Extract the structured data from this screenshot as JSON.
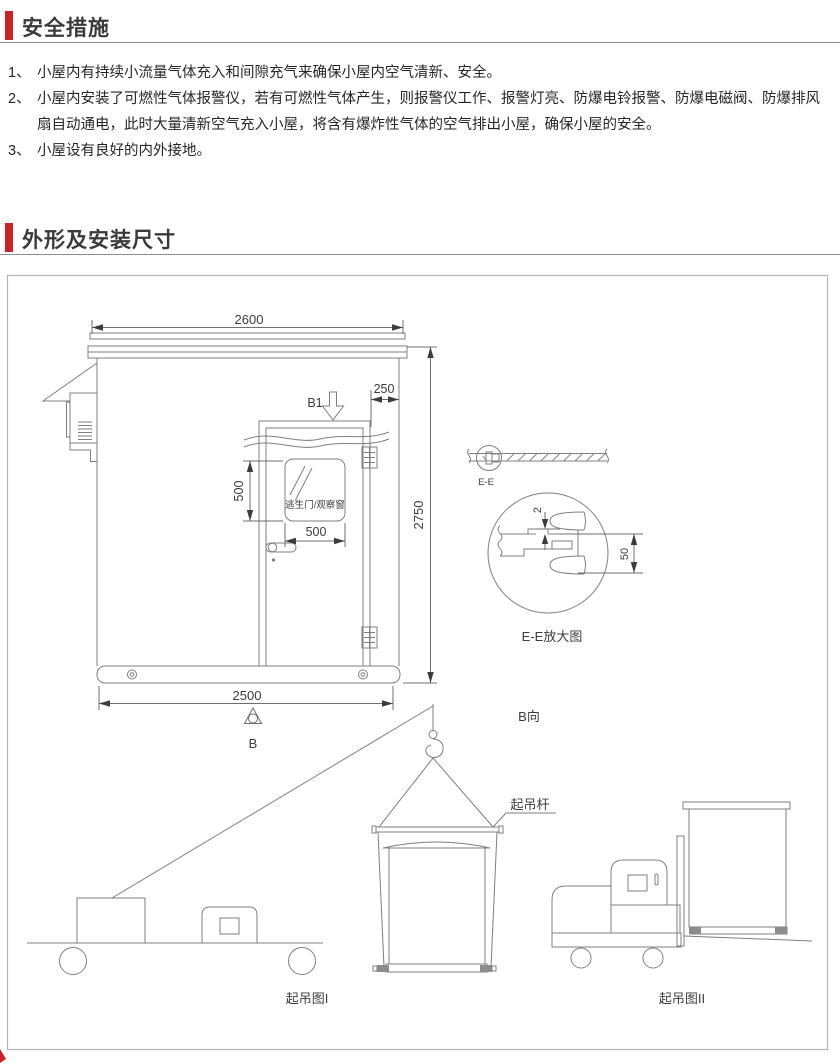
{
  "page": {
    "accent_color": "#cc2128",
    "drawing_line_color": "#7f7f7f"
  },
  "sections": {
    "safety": {
      "title": "安全措施",
      "items": [
        {
          "prefix": "1、",
          "text": "小屋内有持续小流量气体充入和间隙充气来确保小屋内空气清新、安全。"
        },
        {
          "prefix": "2、",
          "text": "小屋内安装了可燃性气体报警仪，若有可燃性气体产生，则报警仪工作、报警灯亮、防爆电铃报警、防爆电磁阀、防爆排风扇自动通电，此时大量清新空气充入小屋，将含有爆炸性气体的空气排出小屋，确保小屋的安全。"
        },
        {
          "prefix": "3、",
          "text": "小屋设有良好的内外接地。"
        }
      ]
    },
    "outline": {
      "title": "外形及安装尺寸",
      "dimensions": {
        "roof_width": "2600",
        "overall_height": "2750",
        "door_to_corner": "250",
        "window_height": "500",
        "window_width": "500",
        "base_width": "2500",
        "panel_gap": "2",
        "panel_overlap": "50"
      },
      "labels": {
        "view_b1": "B1",
        "view_b": "B",
        "door_window": "逃生门/观察窗",
        "section_mark": "E-E",
        "section_detail": "E-E放大图",
        "view_b_dir": "B向",
        "lifting_bar": "起吊杆",
        "lifting_fig_1": "起吊图I",
        "lifting_fig_2": "起吊图II"
      }
    }
  }
}
